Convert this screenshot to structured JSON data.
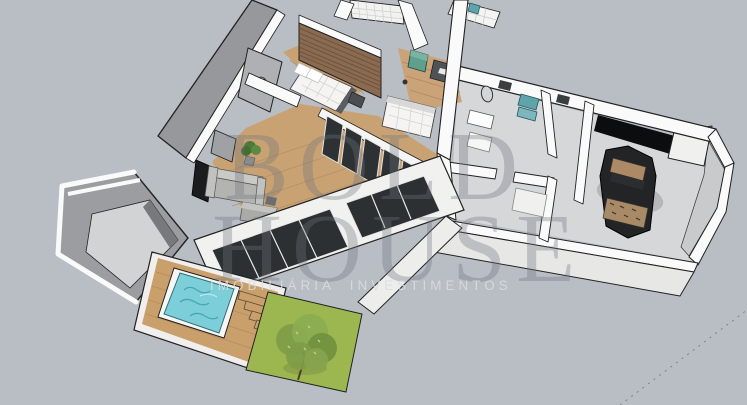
{
  "watermark": {
    "line1": "BOLD",
    "line2": "HOUSE",
    "tagline": "IMOBILIÁRIA  INVESTIMENTOS"
  },
  "palette": {
    "background": "#b9bdc4",
    "wall_top": "#fafafa",
    "wall_face_dark": "#96989b",
    "wall_face_light": "#e7e7e6",
    "floor_wood": "#c9a274",
    "floor_concrete": "#d6d7d8",
    "brick_wall": "#8a6b52",
    "glass": "#2d3134",
    "pool_water": "#7ccfd8",
    "deck_wood": "#c9a06b",
    "lawn": "#9cb750",
    "tree": "#7e9c48",
    "sofa": "#b3b3b1",
    "chair_green": "#5f9f8e",
    "dining_table": "#c49a6c",
    "car_body": "#232426",
    "car_trim_tan": "#ad8a66",
    "fixture_teal": "#5fa3ab",
    "outline": "#222222"
  },
  "scene": {
    "items": [
      "bedroom-bed",
      "brick-feature-wall",
      "office-desk",
      "green-armchair",
      "living-sofa",
      "dining-table",
      "kitchen-glass-wall",
      "bathroom-mirror",
      "laundry-washer",
      "garage-car",
      "swimming-pool",
      "wood-deck",
      "garden-lawn",
      "garden-tree",
      "entry-structure"
    ]
  }
}
